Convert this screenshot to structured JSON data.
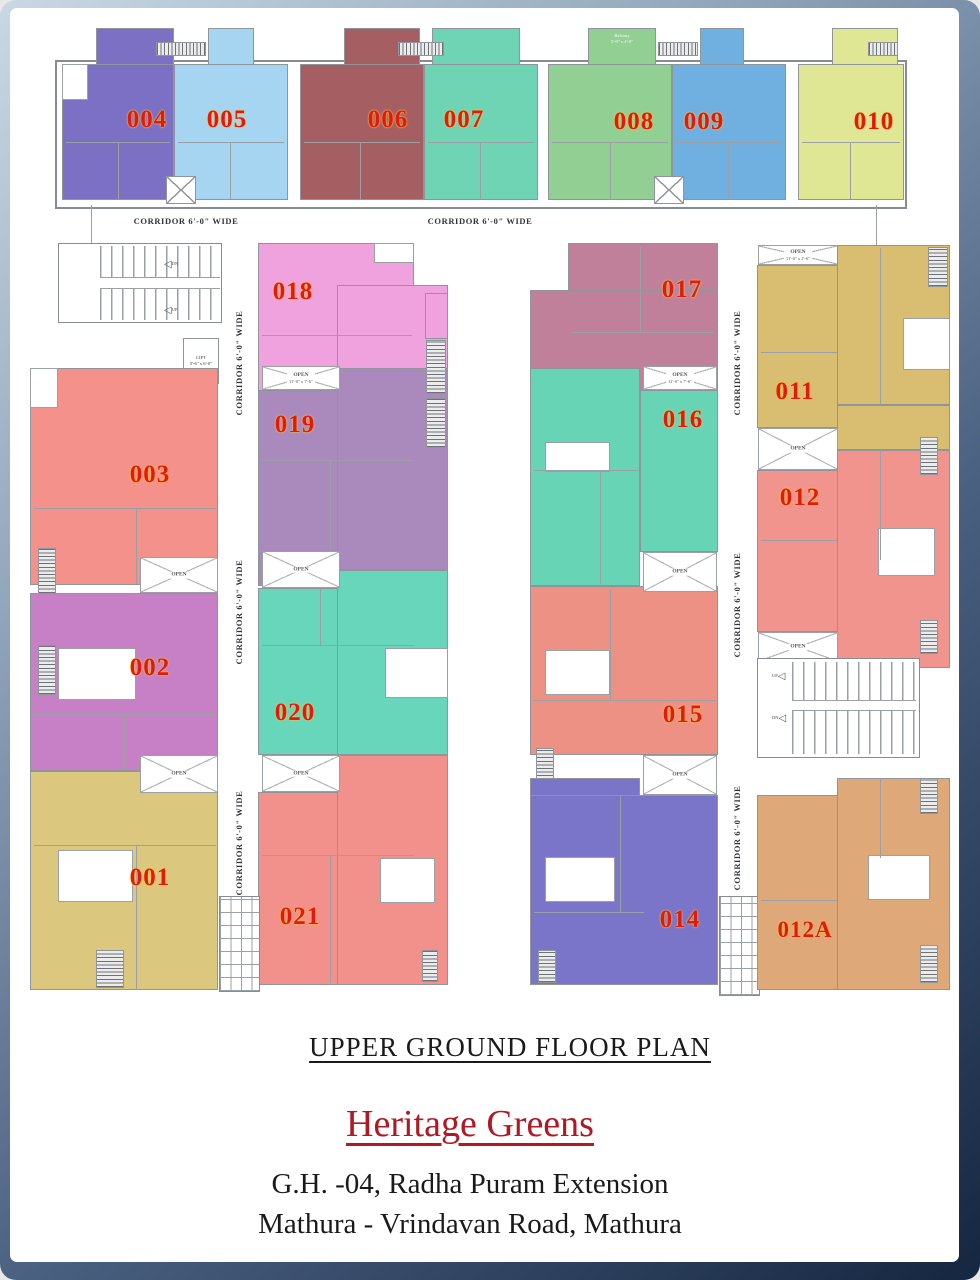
{
  "page": {
    "plan_title": "UPPER GROUND FLOOR PLAN",
    "project_name": "Heritage Greens",
    "address_line1": "G.H. -04, Radha Puram Extension",
    "address_line2": "Mathura - Vrindavan Road, Mathura"
  },
  "labels": {
    "corridor": "CORRIDOR 6'-0\" WIDE",
    "open": "OPEN",
    "open_dim_large": "11'-0\" x 7'-6\"",
    "open_dim_small": "11'-0\" x 2'-6\"",
    "lift_line1": "LIFT",
    "lift_line2": "5'-6\" x 6'-0\"",
    "balcony_line1": "Balcony",
    "balcony_line2": "5'-0\" x 4'-0\"",
    "up": "UP",
    "dn": "DN"
  },
  "colors": {
    "unit_number": "#e2190b",
    "unit_number_glow": "#f5c84a",
    "wall": "#8f959a",
    "title_red": "#b01823",
    "text_black": "#1a1a1a",
    "frame_light": "#c9d8e3",
    "frame_dark": "#152640"
  },
  "units": [
    {
      "label": "001",
      "color": "#dcc77e"
    },
    {
      "label": "002",
      "color": "#c77fc5"
    },
    {
      "label": "003",
      "color": "#f5918b"
    },
    {
      "label": "004",
      "color": "#7c70c5"
    },
    {
      "label": "005",
      "color": "#a5d5f0"
    },
    {
      "label": "006",
      "color": "#a55f63"
    },
    {
      "label": "007",
      "color": "#6fd4b4"
    },
    {
      "label": "008",
      "color": "#92cf92"
    },
    {
      "label": "009",
      "color": "#6fb0e0"
    },
    {
      "label": "010",
      "color": "#dfe795"
    },
    {
      "label": "011",
      "color": "#d9bd71"
    },
    {
      "label": "012",
      "color": "#f2948e"
    },
    {
      "label": "012A",
      "color": "#dfa878"
    },
    {
      "label": "014",
      "color": "#7b75c9"
    },
    {
      "label": "015",
      "color": "#ee9185"
    },
    {
      "label": "016",
      "color": "#68d4b6"
    },
    {
      "label": "017",
      "color": "#c0809a"
    },
    {
      "label": "018",
      "color": "#efa2dd"
    },
    {
      "label": "019",
      "color": "#aa8abd"
    },
    {
      "label": "020",
      "color": "#68d6ba"
    },
    {
      "label": "021",
      "color": "#f2908b"
    }
  ]
}
